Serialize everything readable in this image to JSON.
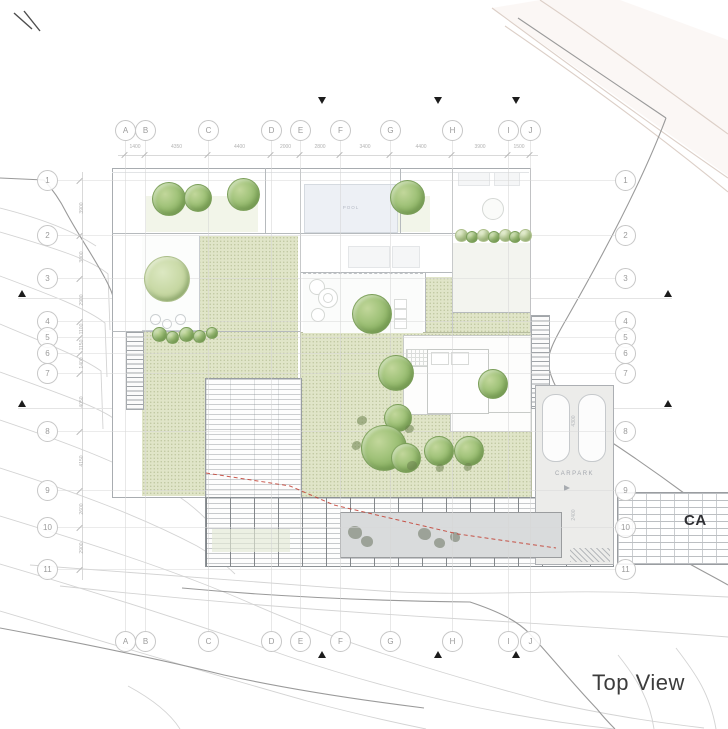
{
  "title": {
    "label": "Top View"
  },
  "plan": {
    "pool_label": "POOL",
    "carpark_label": "CARPARK",
    "boundary_wall_label": "CA",
    "carpark_dim_labels": [
      "4300",
      "2400"
    ]
  },
  "grid": {
    "columns": [
      {
        "label": "A",
        "x": 125
      },
      {
        "label": "B",
        "x": 145
      },
      {
        "label": "C",
        "x": 208
      },
      {
        "label": "D",
        "x": 271
      },
      {
        "label": "E",
        "x": 300
      },
      {
        "label": "F",
        "x": 340
      },
      {
        "label": "G",
        "x": 390
      },
      {
        "label": "H",
        "x": 452
      },
      {
        "label": "I",
        "x": 508
      },
      {
        "label": "J",
        "x": 530
      }
    ],
    "rows": [
      {
        "label": "1",
        "y": 180
      },
      {
        "label": "2",
        "y": 235
      },
      {
        "label": "3",
        "y": 278
      },
      {
        "label": "4",
        "y": 321
      },
      {
        "label": "5",
        "y": 337
      },
      {
        "label": "6",
        "y": 353
      },
      {
        "label": "7",
        "y": 373
      },
      {
        "label": "8",
        "y": 431
      },
      {
        "label": "9",
        "y": 490
      },
      {
        "label": "10",
        "y": 527
      },
      {
        "label": "11",
        "y": 569
      }
    ],
    "top_dims": [
      "1400",
      "4350",
      "4400",
      "2000",
      "2800",
      "3400",
      "4400",
      "3900",
      "1500"
    ],
    "left_dims": [
      "3900",
      "3000",
      "2900",
      "1100",
      "1150",
      "1400",
      "4050",
      "4150",
      "2600",
      "2900"
    ],
    "section_marks": [
      322,
      438,
      516
    ],
    "ref_lines": [
      298,
      408
    ]
  },
  "colors": {
    "lawn": "#e0e5c8",
    "tree_green": "#8fb468",
    "tree_light": "#c9daa8",
    "red_dash": "#c23b2e",
    "road_tint": "#f8f0ec",
    "contour": "#cfcfcf",
    "contour_dark": "#9a9a9a",
    "grid_gray": "#c7c7c7",
    "title_color": "#3c3c3c"
  }
}
